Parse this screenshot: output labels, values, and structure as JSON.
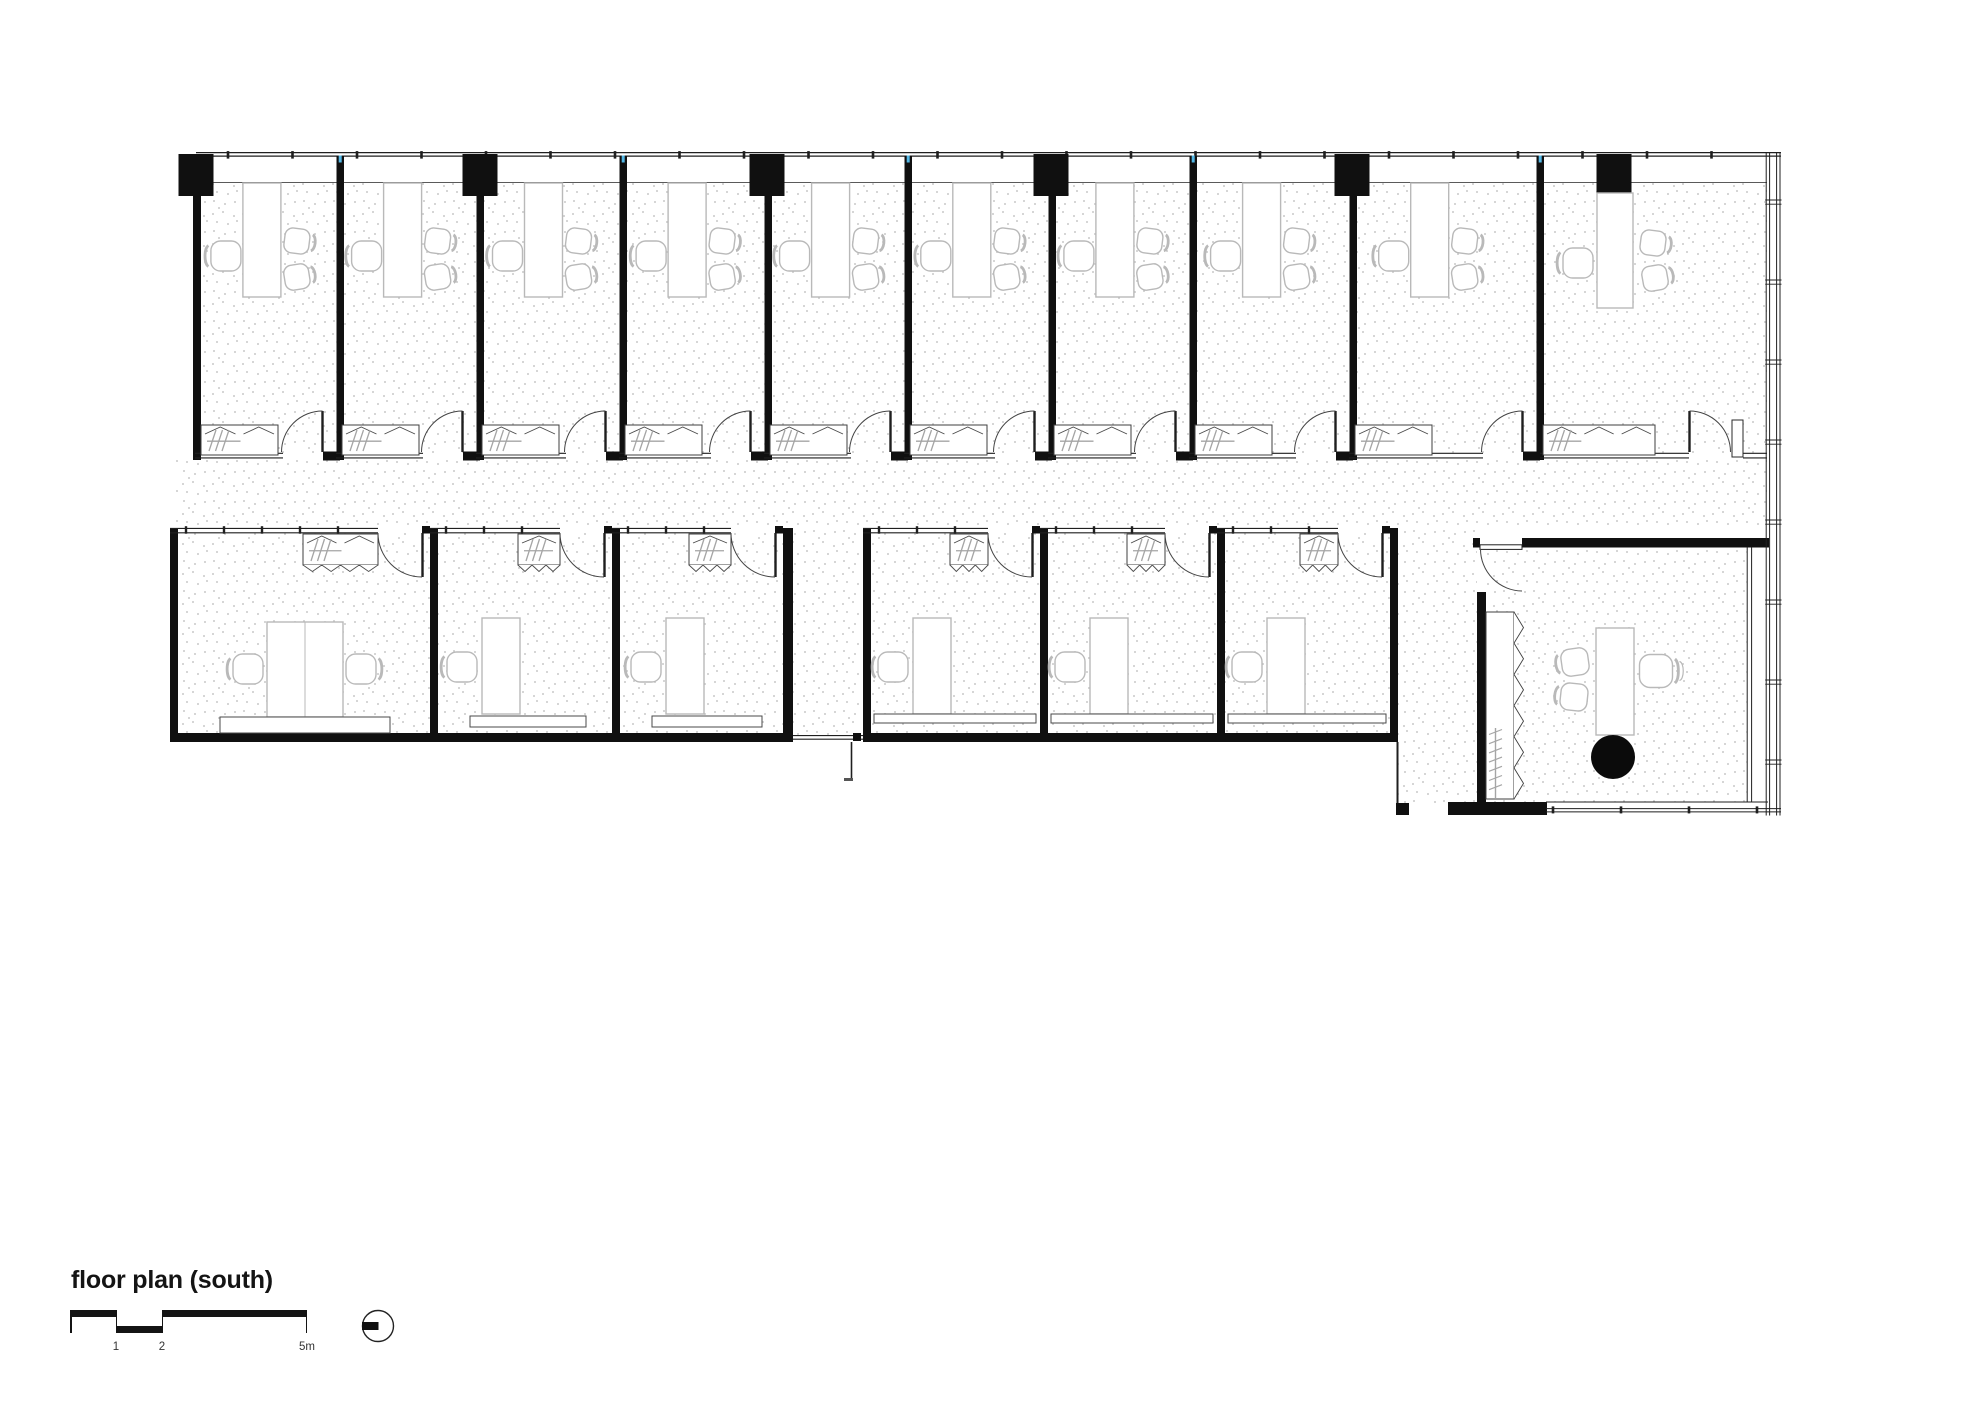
{
  "title": {
    "text": "floor plan (south)"
  },
  "scale_bar": {
    "labels": [
      "1",
      "2",
      "5m"
    ]
  },
  "colors": {
    "wall": "#101010",
    "line": "#1f1f1f",
    "soft": "#4a4a4a",
    "sill": "#5a5a5a",
    "furniture": "#b9b9b9",
    "hanger": "#a5a5a5",
    "stipple": "#c9c9c9",
    "accent_blue": "#54b8e6",
    "table_black": "#0b0b0b"
  },
  "plan": {
    "stipple_dots": [
      [
        3,
        4
      ],
      [
        13,
        2
      ],
      [
        24,
        6
      ],
      [
        7,
        12
      ],
      [
        18,
        14
      ],
      [
        27,
        11
      ],
      [
        4,
        21
      ],
      [
        15,
        24
      ],
      [
        25,
        22
      ],
      [
        9,
        28
      ]
    ],
    "floors": [
      [
        196,
        183,
        1571,
        270,
        "top-rooms-floor"
      ],
      [
        176,
        460,
        1591,
        68,
        "corridor-floor"
      ],
      [
        178,
        533,
        605,
        200,
        "bottom-left-block-floor"
      ],
      [
        793,
        528,
        70,
        207,
        "passage-floor"
      ],
      [
        871,
        533,
        519,
        200,
        "bottom-mid-block-floor"
      ],
      [
        1398,
        528,
        79,
        275,
        "lobby-floor"
      ],
      [
        1486,
        547,
        261,
        255,
        "big-office-floor"
      ]
    ],
    "top_row": {
      "band": {
        "x1": 196,
        "x2": 1781,
        "y1": 152.6,
        "y2": 156.1,
        "sill_y": 182.5,
        "sill_x2": 1767,
        "tick_start": 228,
        "tick_step": 64.5,
        "tick_end": 1762
      },
      "left_wall": [
        193,
        156,
        8,
        304
      ],
      "walls_x": [
        336.5,
        476.5,
        619.5,
        764.5,
        904.5,
        1048.5,
        1189.5,
        1349.5,
        1536.5
      ],
      "wall_w": 7.5,
      "columns": {
        "centers": [
          196,
          480,
          767,
          1051,
          1352,
          1614
        ],
        "y": 154,
        "w": 35,
        "h": 42
      },
      "rooms": [
        {
          "l": 203,
          "r": 336
        },
        {
          "l": 344,
          "r": 476
        },
        {
          "l": 484,
          "r": 619
        },
        {
          "l": 627,
          "r": 764
        },
        {
          "l": 772,
          "r": 904
        },
        {
          "l": 912,
          "r": 1048
        },
        {
          "l": 1056,
          "r": 1189
        },
        {
          "l": 1197,
          "r": 1349
        },
        {
          "l": 1357,
          "r": 1536
        }
      ],
      "room10": {
        "l": 1544,
        "r": 1767,
        "desk": [
          1597,
          193,
          36,
          115
        ],
        "chair_left": [
          1578,
          263
        ],
        "chairs_right": [
          [
            1653,
            243,
            187
          ],
          [
            1655,
            278,
            170
          ]
        ],
        "cabinet": [
          1543,
          425,
          112,
          30
        ],
        "door": {
          "leaf_x": 1689.5,
          "y1": 411,
          "y2": 452,
          "open_r": 1730.5,
          "arc_r": 41
        },
        "stub": [
          1732,
          420,
          11,
          37
        ],
        "bottom_lines": [
          [
            1540,
            1689
          ],
          [
            1743,
            1767
          ]
        ]
      },
      "bottom_y1": 453.3,
      "bottom_y2": 457.9
    },
    "bottom_left_block": {
      "left_wall": [
        170,
        528,
        8,
        214
      ],
      "dividers": [
        [
          430,
          528,
          8,
          206
        ],
        [
          612,
          528,
          8,
          206
        ]
      ],
      "right_wall": [
        783,
        528,
        10,
        214
      ],
      "bottom_wall": [
        170,
        733,
        623,
        9
      ],
      "rooms": [
        {
          "l": 178,
          "r": 430,
          "rack_w": 75,
          "desk": [
            267,
            622,
            76,
            95
          ],
          "chairs": [
            [
              248,
              669,
              0
            ],
            [
              361,
              669,
              180
            ]
          ],
          "sideboard": [
            220,
            717,
            170,
            16
          ]
        },
        {
          "l": 438,
          "r": 612,
          "rack_w": 42,
          "desk": [
            482,
            618,
            38,
            96
          ],
          "chairs": [
            [
              462,
              667,
              0
            ]
          ],
          "sideboard": [
            470,
            716,
            116,
            11
          ]
        },
        {
          "l": 620,
          "r": 783,
          "rack_w": 42,
          "desk": [
            666,
            618,
            38,
            96
          ],
          "chairs": [
            [
              646,
              667,
              0
            ]
          ],
          "sideboard": [
            652,
            716,
            110,
            11
          ]
        }
      ]
    },
    "bottom_mid_block": {
      "left_wall": [
        863,
        528,
        8,
        205
      ],
      "dividers": [
        [
          1040,
          528,
          8,
          205
        ],
        [
          1217,
          528,
          8,
          205
        ]
      ],
      "right_wall": [
        1390,
        528,
        8,
        214
      ],
      "bottom_wall": [
        863,
        733,
        535,
        9
      ],
      "rooms": [
        {
          "l": 871,
          "r": 1040,
          "rack_w": 38,
          "desk": [
            913,
            618,
            38,
            96
          ],
          "chairs": [
            [
              893,
              667,
              0
            ]
          ],
          "sideboard": [
            874,
            714,
            162,
            9
          ]
        },
        {
          "l": 1048,
          "r": 1217,
          "rack_w": 38,
          "desk": [
            1090,
            618,
            38,
            96
          ],
          "chairs": [
            [
              1070,
              667,
              0
            ]
          ],
          "sideboard": [
            1051,
            714,
            162,
            9
          ]
        },
        {
          "l": 1225,
          "r": 1390,
          "rack_w": 38,
          "desk": [
            1267,
            618,
            38,
            96
          ],
          "chairs": [
            [
              1247,
              667,
              0
            ]
          ],
          "sideboard": [
            1228,
            714,
            158,
            9
          ]
        }
      ]
    },
    "bottom_door": {
      "open_w": 44,
      "hinge_off": 8
    },
    "passage": {
      "x1": 793,
      "x2": 863,
      "threshold_y": [
        735.6,
        739.2
      ],
      "nub": [
        853,
        733,
        8,
        8
      ],
      "leaf": [
        851.5,
        742,
        780
      ],
      "tick": [
        844,
        778,
        9,
        3
      ]
    },
    "lobby": {
      "east_line": [
        1397.5,
        742,
        803
      ],
      "nub": [
        1396,
        803,
        13,
        12
      ],
      "black_bar": [
        1448,
        802,
        99,
        13
      ]
    },
    "big_office": {
      "top_stub": [
        1473,
        538,
        7,
        9.5
      ],
      "top_wall": [
        1522,
        538,
        247,
        9.5
      ],
      "left_wall": [
        1477,
        592,
        9,
        211
      ],
      "door": {
        "leaf": [
          1480,
          544.8,
          42,
          4.6
        ],
        "cx": 1522,
        "cy": 549,
        "r": 42
      },
      "wardrobe": {
        "rect": [
          1486,
          612,
          28,
          187
        ],
        "teeth": 6,
        "rail_x": 1495.5,
        "rail_y1": 728,
        "rail_y2": 798
      },
      "desk": [
        1596,
        628,
        38,
        107
      ],
      "guest_chairs": [
        [
          1575,
          662,
          -8
        ],
        [
          1574,
          697,
          6
        ]
      ],
      "exec_chair": [
        1656,
        671,
        180
      ],
      "round_table": [
        1613,
        757,
        22
      ],
      "glass_x": [
        1747.2,
        1751.6
      ],
      "glass_y": [
        547,
        802
      ]
    },
    "facade_right": {
      "xs": [
        1766.2,
        1769.6,
        1776.6,
        1780
      ],
      "y1": 152,
      "y2": 815.5,
      "joint_y0": 200,
      "joint_step": 80,
      "joint_end": 795
    },
    "facade_bottom": {
      "inner": [
        1546,
        1768,
        802
      ],
      "outer_x": [
        1546,
        1781
      ],
      "outer_y": [
        808.6,
        811.9
      ],
      "ticks": [
        1553,
        1621,
        1689,
        1757
      ]
    }
  }
}
